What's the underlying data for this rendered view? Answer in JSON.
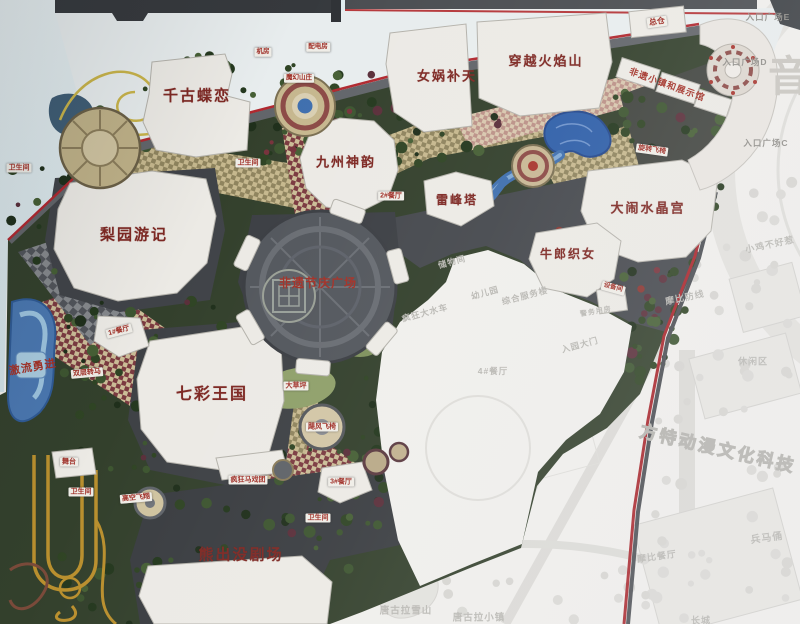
{
  "colors": {
    "border_red": "#a8252b",
    "park_green": "#33402c",
    "water_blue": "#3f6fae",
    "path_tan": "#c6b88e",
    "path_maroon": "#7b3a40",
    "label_red": "#7e2823",
    "faded_board": "#f0efec",
    "sky_blue": "#dfe9ec",
    "frame_dark": "#36393d"
  },
  "labels": [
    {
      "name": "attraction-qiangu-dielian",
      "text": "千古蝶恋",
      "x": 197,
      "y": 96,
      "s": 15,
      "type": "main",
      "rot": 0
    },
    {
      "name": "attraction-nuwa-butian",
      "text": "女娲补天",
      "x": 447,
      "y": 76,
      "s": 13,
      "type": "main",
      "rot": 0
    },
    {
      "name": "attraction-chuanyue-huoyanshan",
      "text": "穿越火焰山",
      "x": 546,
      "y": 61,
      "s": 13,
      "type": "main",
      "rot": 0
    },
    {
      "name": "attraction-jiuzhou-shenyun",
      "text": "九州神韵",
      "x": 346,
      "y": 162,
      "s": 13,
      "type": "main",
      "rot": 0
    },
    {
      "name": "attraction-leifeng-ta",
      "text": "雷峰塔",
      "x": 457,
      "y": 200,
      "s": 12,
      "type": "main",
      "rot": 0
    },
    {
      "name": "attraction-danao-shuijinggong",
      "text": "大闹水晶宫",
      "x": 648,
      "y": 208,
      "s": 13,
      "type": "main",
      "rot": 0
    },
    {
      "name": "attraction-niulang-zhinv",
      "text": "牛郎织女",
      "x": 568,
      "y": 254,
      "s": 12,
      "type": "main",
      "rot": 0
    },
    {
      "name": "attraction-liyuan-youji",
      "text": "梨园游记",
      "x": 134,
      "y": 235,
      "s": 15,
      "type": "main",
      "rot": 0
    },
    {
      "name": "attraction-qicai-wangguo",
      "text": "七彩王国",
      "x": 212,
      "y": 395,
      "s": 16,
      "type": "main",
      "rot": 0
    },
    {
      "name": "attraction-xiongchumo-theater",
      "text": "熊出没剧场",
      "x": 241,
      "y": 555,
      "s": 15,
      "type": "main",
      "rot": 0
    },
    {
      "name": "plaza-feiyi-festival",
      "text": "非遗节庆广场",
      "x": 318,
      "y": 283,
      "s": 12,
      "type": "plain",
      "rot": 0
    },
    {
      "name": "attraction-jiliu-yongjin",
      "text": "激流勇进",
      "x": 33,
      "y": 368,
      "s": 11,
      "type": "plain",
      "rot": -10
    },
    {
      "name": "feiyi-town-exhibition-hall",
      "text": "非遗小镇和展示馆",
      "x": 667,
      "y": 85,
      "s": 9,
      "type": "plain",
      "rot": 20
    },
    {
      "name": "warehouse-tag",
      "text": "总仓",
      "x": 657,
      "y": 22,
      "s": 8,
      "type": "tag",
      "rot": -8
    },
    {
      "name": "restroom-tag-west",
      "text": "卫生间",
      "x": 19,
      "y": 168,
      "s": 7,
      "type": "tag",
      "rot": 0
    },
    {
      "name": "restroom-tag-north",
      "text": "卫生间",
      "x": 248,
      "y": 163,
      "s": 7,
      "type": "tag",
      "rot": 0
    },
    {
      "name": "restaurant-2-tag",
      "text": "2#餐厅",
      "x": 391,
      "y": 196,
      "s": 7,
      "type": "tag",
      "rot": 0
    },
    {
      "name": "spin-chairs-tag",
      "text": "旋转飞椅",
      "x": 652,
      "y": 150,
      "s": 7,
      "type": "tag",
      "rot": 8
    },
    {
      "name": "restaurant-1-tag",
      "text": "1#餐厅",
      "x": 119,
      "y": 331,
      "s": 7,
      "type": "tag",
      "rot": -15
    },
    {
      "name": "double-carousel-tag",
      "text": "双层转马",
      "x": 87,
      "y": 373,
      "s": 7,
      "type": "tag",
      "rot": -5
    },
    {
      "name": "stage-tag",
      "text": "舞台",
      "x": 69,
      "y": 462,
      "s": 7,
      "type": "tag",
      "rot": 0
    },
    {
      "name": "restroom-tag-southwest",
      "text": "卫生间",
      "x": 81,
      "y": 492,
      "s": 7,
      "type": "tag",
      "rot": 0
    },
    {
      "name": "sky-flyer-tag",
      "text": "高空飞翔",
      "x": 136,
      "y": 498,
      "s": 7,
      "type": "tag",
      "rot": -5
    },
    {
      "name": "crazy-circus-tag",
      "text": "疯狂马戏团",
      "x": 248,
      "y": 480,
      "s": 7,
      "type": "tag",
      "rot": 0
    },
    {
      "name": "hurricane-chairs-tag",
      "text": "飓风飞椅",
      "x": 322,
      "y": 427,
      "s": 7,
      "type": "tag",
      "rot": 0
    },
    {
      "name": "restaurant-3-tag",
      "text": "3#餐厅",
      "x": 341,
      "y": 482,
      "s": 7,
      "type": "tag",
      "rot": 0
    },
    {
      "name": "restroom-tag-south",
      "text": "卫生间",
      "x": 318,
      "y": 518,
      "s": 7,
      "type": "tag",
      "rot": 0
    },
    {
      "name": "lawn-tag",
      "text": "大草坪",
      "x": 296,
      "y": 386,
      "s": 7,
      "type": "tag",
      "rot": 0
    },
    {
      "name": "machine-room-tag",
      "text": "机房",
      "x": 263,
      "y": 52,
      "s": 6.5,
      "type": "tag",
      "rot": 0
    },
    {
      "name": "power-room-tag",
      "text": "配电房",
      "x": 318,
      "y": 47,
      "s": 6.5,
      "type": "tag",
      "rot": 0
    },
    {
      "name": "mohuan-villa-tag",
      "text": "魔幻山庄",
      "x": 299,
      "y": 78,
      "s": 6.5,
      "type": "tag",
      "rot": 0
    },
    {
      "name": "equipment-room-tag",
      "text": "设备间",
      "x": 613,
      "y": 288,
      "s": 6.5,
      "type": "tag",
      "rot": 15
    },
    {
      "name": "police-room-label",
      "text": "警务用房",
      "x": 596,
      "y": 312,
      "s": 7,
      "type": "faded",
      "rot": -10
    },
    {
      "name": "entrance-plaza-e",
      "text": "入口广场E",
      "x": 768,
      "y": 17,
      "s": 8.5,
      "type": "entrance",
      "rot": 0
    },
    {
      "name": "entrance-plaza-d",
      "text": "入口广场D",
      "x": 745,
      "y": 62,
      "s": 8.5,
      "type": "entrance",
      "rot": 0
    },
    {
      "name": "entrance-plaza-c",
      "text": "入口广场C",
      "x": 766,
      "y": 143,
      "s": 8.5,
      "type": "entrance",
      "rot": 0
    },
    {
      "name": "yin-watermark",
      "text": "音",
      "x": 789,
      "y": 77,
      "s": 42,
      "type": "watermark",
      "rot": 0
    },
    {
      "name": "fantawild-watermark",
      "text": "方特动漫文化科技",
      "x": 718,
      "y": 449,
      "s": 17,
      "type": "outline",
      "rot": 13
    },
    {
      "name": "storage-room-label",
      "text": "储物间",
      "x": 452,
      "y": 262,
      "s": 8.5,
      "type": "faded",
      "rot": -15
    },
    {
      "name": "kindergarten-label",
      "text": "幼儿园",
      "x": 485,
      "y": 293,
      "s": 8.5,
      "type": "faded",
      "rot": -15
    },
    {
      "name": "service-building-label",
      "text": "综合服务楼",
      "x": 525,
      "y": 296,
      "s": 8.5,
      "type": "faded",
      "rot": -15
    },
    {
      "name": "main-gate-label",
      "text": "入园大门",
      "x": 580,
      "y": 345,
      "s": 8.5,
      "type": "faded",
      "rot": -15
    },
    {
      "name": "restaurant-4-label",
      "text": "4#餐厅",
      "x": 493,
      "y": 371,
      "s": 8.5,
      "type": "faded",
      "rot": 0
    },
    {
      "name": "water-wheel-label",
      "text": "疯狂大水车",
      "x": 425,
      "y": 313,
      "s": 8.5,
      "type": "faded",
      "rot": -15
    },
    {
      "name": "tanggula-mountain-label",
      "text": "唐古拉雪山",
      "x": 406,
      "y": 611,
      "s": 9.5,
      "type": "faded",
      "rot": 0
    },
    {
      "name": "tanggula-town-label",
      "text": "唐古拉小镇",
      "x": 479,
      "y": 618,
      "s": 9.5,
      "type": "faded",
      "rot": 0
    },
    {
      "name": "chicken-area-label",
      "text": "小鸡不好惹",
      "x": 770,
      "y": 245,
      "s": 9,
      "type": "faded",
      "rot": -12
    },
    {
      "name": "mobi-line-label",
      "text": "摩比防线",
      "x": 685,
      "y": 298,
      "s": 9,
      "type": "faded",
      "rot": -12
    },
    {
      "name": "leisure-area-label",
      "text": "休闲区",
      "x": 753,
      "y": 362,
      "s": 9,
      "type": "faded",
      "rot": 0
    },
    {
      "name": "terracotta-label",
      "text": "兵马俑",
      "x": 767,
      "y": 539,
      "s": 10,
      "type": "faded",
      "rot": -8
    },
    {
      "name": "mobi-restaurant-label",
      "text": "摩比餐厅",
      "x": 657,
      "y": 557,
      "s": 9,
      "type": "faded",
      "rot": -8
    },
    {
      "name": "great-wall-label",
      "text": "长城",
      "x": 701,
      "y": 621,
      "s": 9,
      "type": "faded",
      "rot": 0
    }
  ]
}
